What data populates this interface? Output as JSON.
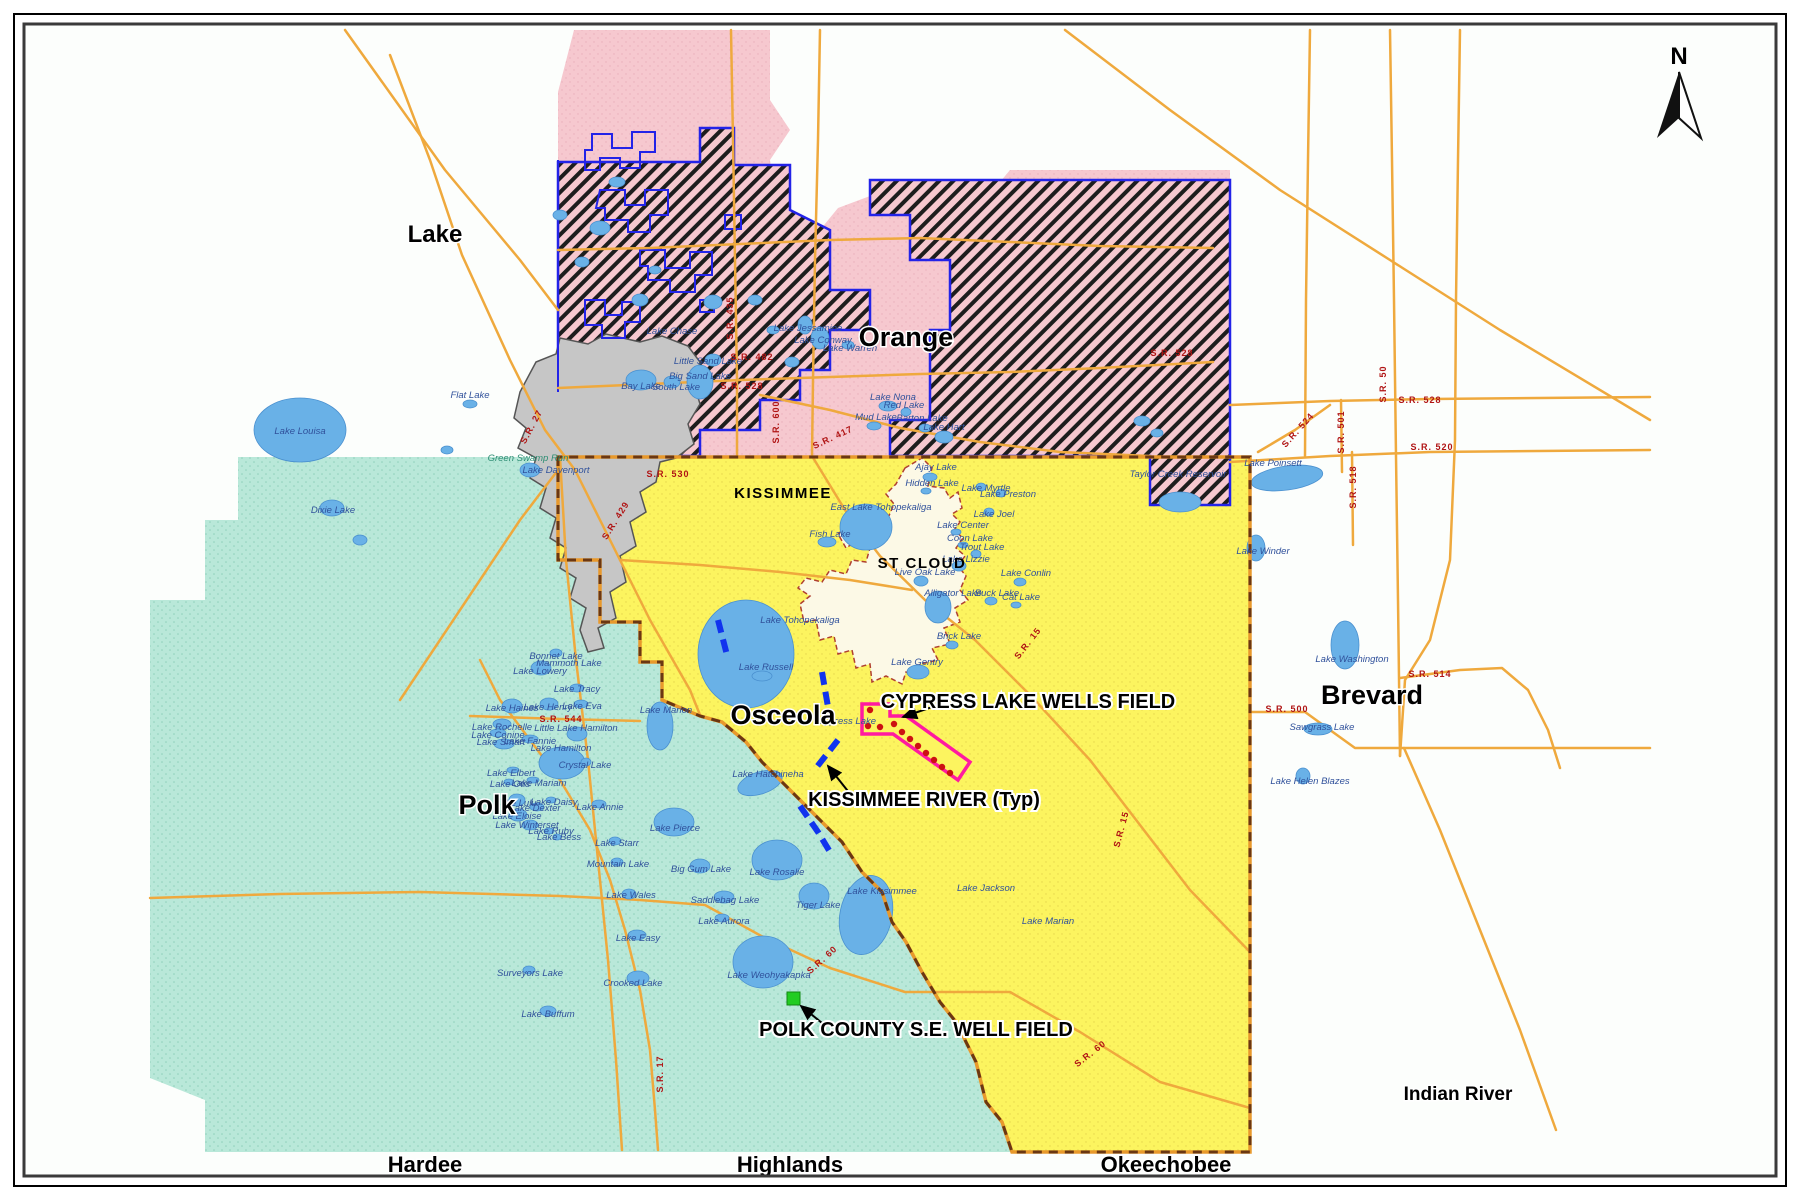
{
  "map": {
    "north_label": "N",
    "county_labels": [
      {
        "label": "Lake",
        "x": 435,
        "y": 242,
        "size": 24
      },
      {
        "label": "Orange",
        "x": 906,
        "y": 346,
        "size": 27
      },
      {
        "label": "Osceola",
        "x": 783,
        "y": 724,
        "size": 27
      },
      {
        "label": "Polk",
        "x": 487,
        "y": 814,
        "size": 27
      },
      {
        "label": "Brevard",
        "x": 1372,
        "y": 704,
        "size": 27
      },
      {
        "label": "Hardee",
        "x": 425,
        "y": 1172,
        "size": 22
      },
      {
        "label": "Highlands",
        "x": 790,
        "y": 1172,
        "size": 22
      },
      {
        "label": "Okeechobee",
        "x": 1166,
        "y": 1172,
        "size": 22
      },
      {
        "label": "Indian River",
        "x": 1458,
        "y": 1100,
        "size": 19
      }
    ],
    "city_labels": [
      {
        "label": "KISSIMMEE",
        "x": 783,
        "y": 498,
        "size": 15
      },
      {
        "label": "ST CLOUD",
        "x": 922,
        "y": 568,
        "size": 16
      }
    ],
    "annotations": {
      "cypress": {
        "label": "CYPRESS LAKE WELLS FIELD",
        "x": 1028,
        "y": 708
      },
      "kissimmee_river": {
        "label": "KISSIMMEE RIVER (Typ)",
        "x": 924,
        "y": 806
      },
      "polk_wells": {
        "label": "POLK COUNTY S.E. WELL FIELD",
        "x": 916,
        "y": 1036
      }
    },
    "lake_labels": [
      {
        "label": "Lake Louisa",
        "x": 300,
        "y": 434
      },
      {
        "label": "Dixie Lake",
        "x": 333,
        "y": 513
      },
      {
        "label": "Flat Lake",
        "x": 470,
        "y": 398
      },
      {
        "label": "Lake Davenport",
        "x": 556,
        "y": 473
      },
      {
        "label": "Lake Chase",
        "x": 672,
        "y": 334
      },
      {
        "label": "Little Sand Lake",
        "x": 708,
        "y": 364
      },
      {
        "label": "Big Sand Lake",
        "x": 700,
        "y": 379
      },
      {
        "label": "Bay Lake",
        "x": 641,
        "y": 389
      },
      {
        "label": "South Lake",
        "x": 676,
        "y": 390
      },
      {
        "label": "Lake Jessamine",
        "x": 808,
        "y": 331
      },
      {
        "label": "Lake Conway",
        "x": 823,
        "y": 343
      },
      {
        "label": "Lake Warren",
        "x": 850,
        "y": 351
      },
      {
        "label": "Lake Nona",
        "x": 893,
        "y": 400
      },
      {
        "label": "Red Lake",
        "x": 904,
        "y": 408
      },
      {
        "label": "Mud Lake",
        "x": 876,
        "y": 420
      },
      {
        "label": "Barton Lake",
        "x": 922,
        "y": 421
      },
      {
        "label": "Lake Hart",
        "x": 944,
        "y": 430
      },
      {
        "label": "Ajay Lake",
        "x": 936,
        "y": 470
      },
      {
        "label": "Hidden Lake",
        "x": 932,
        "y": 486
      },
      {
        "label": "Lake Myrtle",
        "x": 986,
        "y": 491
      },
      {
        "label": "Lake Preston",
        "x": 1008,
        "y": 497
      },
      {
        "label": "Lake Joel",
        "x": 994,
        "y": 517
      },
      {
        "label": "East Lake Tohopekaliga",
        "x": 881,
        "y": 510
      },
      {
        "label": "Lake Center",
        "x": 963,
        "y": 528
      },
      {
        "label": "Coon Lake",
        "x": 970,
        "y": 541
      },
      {
        "label": "Trout Lake",
        "x": 982,
        "y": 550
      },
      {
        "label": "Lake Lizzie",
        "x": 966,
        "y": 562
      },
      {
        "label": "Live Oak Lake",
        "x": 925,
        "y": 575
      },
      {
        "label": "Lake Conlin",
        "x": 1026,
        "y": 576
      },
      {
        "label": "Alligator Lake",
        "x": 953,
        "y": 596
      },
      {
        "label": "Buck Lake",
        "x": 997,
        "y": 596
      },
      {
        "label": "Cat Lake",
        "x": 1021,
        "y": 600
      },
      {
        "label": "Fish Lake",
        "x": 830,
        "y": 537
      },
      {
        "label": "Lake Tohopekaliga",
        "x": 800,
        "y": 623
      },
      {
        "label": "Brick Lake",
        "x": 959,
        "y": 639
      },
      {
        "label": "Lake Gentry",
        "x": 917,
        "y": 665
      },
      {
        "label": "Lake Russell",
        "x": 766,
        "y": 670
      },
      {
        "label": "Cypress Lake",
        "x": 847,
        "y": 724
      },
      {
        "label": "Lake Marion",
        "x": 666,
        "y": 713
      },
      {
        "label": "Lake Hatchineha",
        "x": 768,
        "y": 777
      },
      {
        "label": "Bonnet Lake",
        "x": 556,
        "y": 659
      },
      {
        "label": "Mammoth Lake",
        "x": 569,
        "y": 666
      },
      {
        "label": "Lake Lowery",
        "x": 540,
        "y": 674
      },
      {
        "label": "Lake Tracy",
        "x": 577,
        "y": 692
      },
      {
        "label": "Lake Haines",
        "x": 512,
        "y": 711
      },
      {
        "label": "Lake Henry",
        "x": 548,
        "y": 710
      },
      {
        "label": "Lake Eva",
        "x": 582,
        "y": 709
      },
      {
        "label": "Lake Rochelle",
        "x": 502,
        "y": 730
      },
      {
        "label": "Lake Conine",
        "x": 498,
        "y": 738
      },
      {
        "label": "Lake Smart",
        "x": 501,
        "y": 745
      },
      {
        "label": "Lake Fannie",
        "x": 530,
        "y": 744
      },
      {
        "label": "Little Lake Hamilton",
        "x": 576,
        "y": 731
      },
      {
        "label": "Lake Hamilton",
        "x": 561,
        "y": 751
      },
      {
        "label": "Crystal Lake",
        "x": 585,
        "y": 768
      },
      {
        "label": "Lake Elbert",
        "x": 511,
        "y": 776
      },
      {
        "label": "Lake Otis",
        "x": 510,
        "y": 787
      },
      {
        "label": "Lake Mariam",
        "x": 539,
        "y": 786
      },
      {
        "label": "Lake Lulu",
        "x": 516,
        "y": 806
      },
      {
        "label": "Lake Daisy",
        "x": 554,
        "y": 805
      },
      {
        "label": "Lake Dexter",
        "x": 535,
        "y": 811
      },
      {
        "label": "Lake Eloise",
        "x": 517,
        "y": 819
      },
      {
        "label": "Lake Winterset",
        "x": 527,
        "y": 828
      },
      {
        "label": "Lake Ruby",
        "x": 551,
        "y": 834
      },
      {
        "label": "Lake Bess",
        "x": 559,
        "y": 840
      },
      {
        "label": "Lake Annie",
        "x": 600,
        "y": 810
      },
      {
        "label": "Lake Starr",
        "x": 617,
        "y": 846
      },
      {
        "label": "Mountain Lake",
        "x": 618,
        "y": 867
      },
      {
        "label": "Lake Wales",
        "x": 631,
        "y": 898
      },
      {
        "label": "Lake Pierce",
        "x": 675,
        "y": 831
      },
      {
        "label": "Big Gum Lake",
        "x": 701,
        "y": 872
      },
      {
        "label": "Lake Rosalie",
        "x": 777,
        "y": 875
      },
      {
        "label": "Saddlebag Lake",
        "x": 725,
        "y": 903
      },
      {
        "label": "Tiger Lake",
        "x": 818,
        "y": 908
      },
      {
        "label": "Lake Aurora",
        "x": 724,
        "y": 924
      },
      {
        "label": "Lake Easy",
        "x": 638,
        "y": 941
      },
      {
        "label": "Lake Weohyakapka",
        "x": 769,
        "y": 978
      },
      {
        "label": "Crooked Lake",
        "x": 633,
        "y": 986
      },
      {
        "label": "Surveyors Lake",
        "x": 530,
        "y": 976
      },
      {
        "label": "Lake Buffum",
        "x": 548,
        "y": 1017
      },
      {
        "label": "Lake Kissimmee",
        "x": 882,
        "y": 894
      },
      {
        "label": "Lake Jackson",
        "x": 986,
        "y": 891
      },
      {
        "label": "Lake Marian",
        "x": 1048,
        "y": 924
      },
      {
        "label": "Lake Poinsett",
        "x": 1273,
        "y": 466
      },
      {
        "label": "Lake Winder",
        "x": 1263,
        "y": 554
      },
      {
        "label": "Lake Washington",
        "x": 1352,
        "y": 662
      },
      {
        "label": "Sawgrass Lake",
        "x": 1322,
        "y": 730
      },
      {
        "label": "Lake Helen Blazes",
        "x": 1310,
        "y": 784
      },
      {
        "label": "Taylor Creek Reservoir",
        "x": 1178,
        "y": 477
      }
    ],
    "stream_labels": [
      {
        "label": "Green Swamp Run",
        "x": 528,
        "y": 461
      }
    ],
    "road_labels": [
      {
        "label": "S.R. 435",
        "x": 733,
        "y": 318,
        "rotate": -90
      },
      {
        "label": "S.R. 482",
        "x": 752,
        "y": 360
      },
      {
        "label": "S.R. 528",
        "x": 742,
        "y": 389
      },
      {
        "label": "S.R. 600",
        "x": 779,
        "y": 422,
        "rotate": -90
      },
      {
        "label": "S.R. 417",
        "x": 834,
        "y": 440,
        "rotate": -25
      },
      {
        "label": "S.R. 528",
        "x": 1172,
        "y": 356
      },
      {
        "label": "S.R. 528",
        "x": 1420,
        "y": 403
      },
      {
        "label": "S.R. 520",
        "x": 1432,
        "y": 450
      },
      {
        "label": "S.R. 524",
        "x": 1300,
        "y": 432,
        "rotate": -48
      },
      {
        "label": "S.R. 501",
        "x": 1344,
        "y": 432,
        "rotate": -90
      },
      {
        "label": "S.R. 518",
        "x": 1356,
        "y": 487,
        "rotate": -90
      },
      {
        "label": "S.R. 50",
        "x": 1386,
        "y": 384,
        "rotate": -90
      },
      {
        "label": "S.R. 514",
        "x": 1430,
        "y": 677
      },
      {
        "label": "S.R. 500",
        "x": 1287,
        "y": 712
      },
      {
        "label": "S.R. 530",
        "x": 668,
        "y": 477
      },
      {
        "label": "S.R. 429",
        "x": 618,
        "y": 522,
        "rotate": -58
      },
      {
        "label": "S.R. 544",
        "x": 561,
        "y": 722
      },
      {
        "label": "S.R. 27",
        "x": 534,
        "y": 428,
        "rotate": -62
      },
      {
        "label": "S.R. 60",
        "x": 824,
        "y": 962,
        "rotate": -42
      },
      {
        "label": "S.R. 15",
        "x": 1030,
        "y": 645,
        "rotate": -52
      },
      {
        "label": "S.R. 15",
        "x": 1124,
        "y": 830,
        "rotate": -75
      },
      {
        "label": "S.R. 17",
        "x": 663,
        "y": 1074,
        "rotate": -90
      },
      {
        "label": "S.R. 60",
        "x": 1092,
        "y": 1056,
        "rotate": -38
      }
    ],
    "colors": {
      "polk_fill": "#b9e8d9",
      "osceola_fill": "#fcf45f",
      "orange_service_fill": "#f6c8cf",
      "hatch_stripe": "#1d1d1d",
      "city_gray_fill": "#c6c6c6",
      "st_cloud_fill": "#fcf9e6",
      "lake_blue": "#69b1e7",
      "road_orange": "#efa93d",
      "boundary_blue": "#2323e8",
      "county_dash_brown": "#6b3712",
      "wells_outline_magenta": "#ff1aa0",
      "well_dot_red": "#cc1111",
      "green_square": "#22cc22"
    }
  }
}
